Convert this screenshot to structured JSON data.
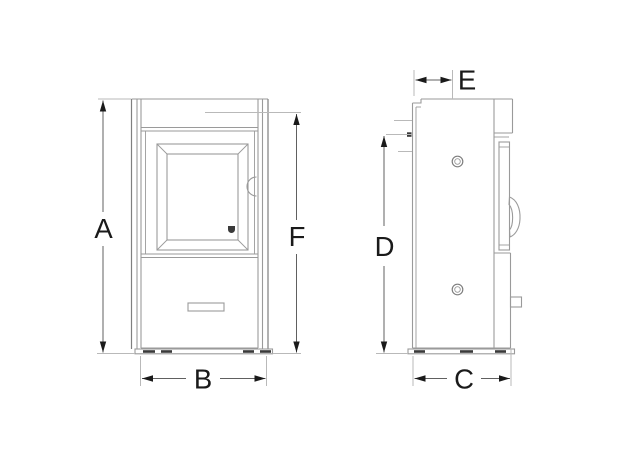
{
  "page": {
    "background": "#ffffff"
  },
  "colors": {
    "background": "#ffffff",
    "body-line": "#9a9a9a",
    "body-line-dark": "#7f7f7f",
    "ext-line": "#b9b9b9",
    "dim-line": "#606060",
    "arrow": "#1a1a1a",
    "label": "#1a1a1a",
    "detail-fill": "#3a3a3a"
  },
  "drawing": {
    "views": {
      "front": {
        "name": "front-view"
      },
      "side": {
        "name": "side-view"
      }
    },
    "icons": {
      "door_logo": "brand-mark-icon",
      "screws": "screw-head-icon"
    }
  },
  "dimensions": {
    "A": "A",
    "B": "B",
    "C": "C",
    "D": "D",
    "E": "E",
    "F": "F"
  }
}
